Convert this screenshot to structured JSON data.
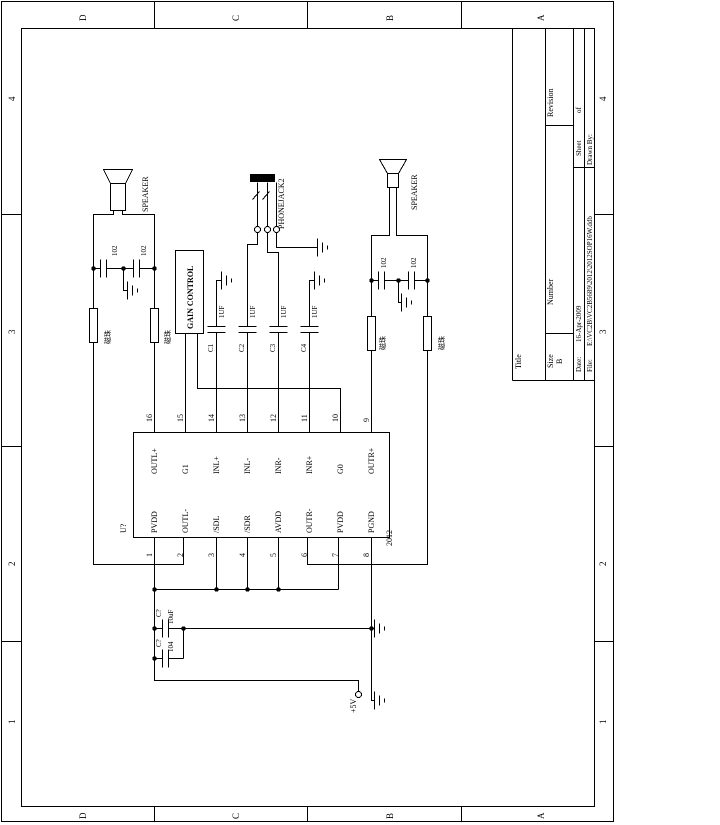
{
  "sheet": {
    "zones": [
      "D",
      "C",
      "B",
      "A"
    ],
    "numbers": [
      "4",
      "3",
      "2",
      "1"
    ],
    "title_block": {
      "title_label": "Title",
      "size_label": "Size",
      "size_value": "B",
      "number_label": "Number",
      "revision_label": "Revision",
      "date_label": "Date:",
      "date_value": "16-Apr-2009",
      "sheet_label": "Sheet",
      "of_label": "of",
      "file_label": "File:",
      "file_value": "E:\\VC2B\\VC2B5689\\2012\\2012SOP16W.ddb",
      "drawn_label": "Drawn By:"
    }
  },
  "ic": {
    "designator": "U?",
    "part": "2012",
    "pins_top": [
      {
        "num": "16",
        "name": "OUTL+"
      },
      {
        "num": "15",
        "name": "G1"
      },
      {
        "num": "14",
        "name": "INL+"
      },
      {
        "num": "13",
        "name": "INL-"
      },
      {
        "num": "12",
        "name": "INR-"
      },
      {
        "num": "11",
        "name": "INR+"
      },
      {
        "num": "10",
        "name": "G0"
      },
      {
        "num": "9",
        "name": "OUTR+"
      }
    ],
    "pins_bottom": [
      {
        "num": "1",
        "name": "PVDD"
      },
      {
        "num": "2",
        "name": "OUTL-"
      },
      {
        "num": "3",
        "name": "/SDL"
      },
      {
        "num": "4",
        "name": "/SDR"
      },
      {
        "num": "5",
        "name": "AVDD"
      },
      {
        "num": "6",
        "name": "OUTR-"
      },
      {
        "num": "7",
        "name": "PVDD"
      },
      {
        "num": "8",
        "name": "PGND"
      }
    ]
  },
  "components": {
    "gain_control": "GAIN CONTROL",
    "phonejack": "PHONEJACK2",
    "speaker_top": "SPEAKER",
    "speaker_bottom": "SPEAKER",
    "caps_input": [
      {
        "ref": "C1",
        "value": "1UF"
      },
      {
        "ref": "C2",
        "value": "1UF"
      },
      {
        "ref": "C3",
        "value": "1UF"
      },
      {
        "ref": "C4",
        "value": "1UF"
      }
    ],
    "caps_speaker_top": [
      "102",
      "102"
    ],
    "caps_speaker_bottom": [
      "102",
      "102"
    ],
    "bead_label": "磁珠",
    "caps_supply": [
      {
        "ref": "C?",
        "value": "10uF"
      },
      {
        "ref": "C?",
        "value": "104"
      }
    ],
    "power_net": "+5V"
  }
}
